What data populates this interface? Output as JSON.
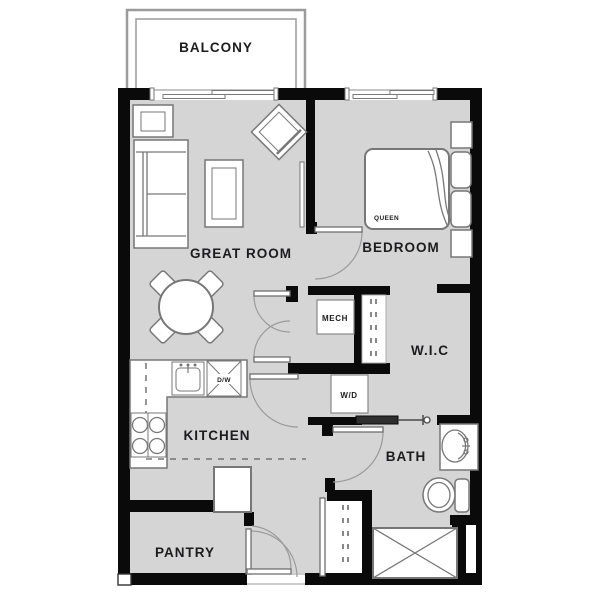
{
  "floorplan": {
    "rooms": {
      "balcony": "BALCONY",
      "great_room": "GREAT ROOM",
      "bedroom": "BEDROOM",
      "wic": "W.I.C",
      "kitchen": "KITCHEN",
      "bath": "BATH",
      "pantry": "PANTRY"
    },
    "fixtures": {
      "mech": "MECH",
      "washer_dryer": "W/D",
      "dishwasher": "D/W",
      "bed_size": "QUEEN"
    },
    "colors": {
      "wall": "#0a0a0a",
      "floor": "#d5d5d5",
      "furniture_stroke": "#777777",
      "door_arc": "#9b9b9b",
      "balcony_stroke": "#9b9b9b",
      "text": "#1c1c1e"
    }
  }
}
